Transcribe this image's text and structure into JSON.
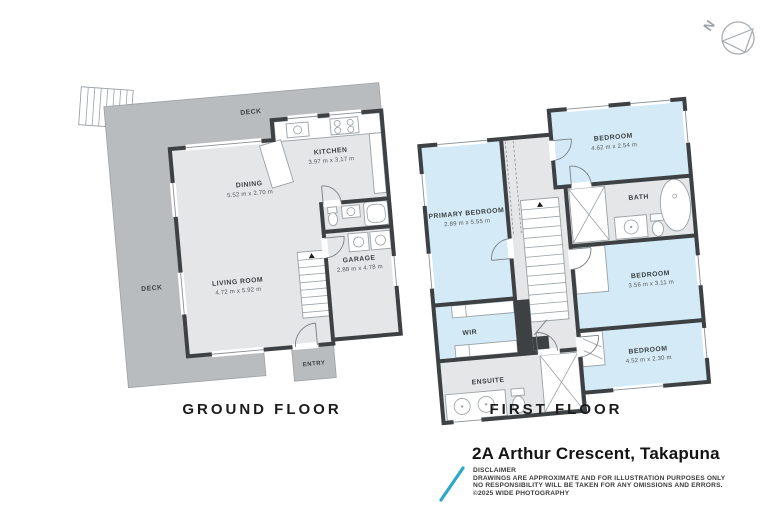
{
  "compass": {
    "north_label": "N"
  },
  "ground_floor": {
    "title": "GROUND FLOOR",
    "deck_label": "DECK",
    "rooms": {
      "kitchen": {
        "name": "KITCHEN",
        "dims": "3.97 m x 3.17 m"
      },
      "dining": {
        "name": "DINING",
        "dims": "5.52 m x 2.70 m"
      },
      "living": {
        "name": "LIVING ROOM",
        "dims": "4.72 m x 5.92 m"
      },
      "garage": {
        "name": "GARAGE",
        "dims": "2.88 m x 4.78 m"
      },
      "entry": {
        "name": "ENTRY"
      }
    }
  },
  "first_floor": {
    "title": "FIRST FLOOR",
    "rooms": {
      "primary": {
        "name": "PRIMARY BEDROOM",
        "dims": "2.89 m x 5.55 m"
      },
      "bedroom_top": {
        "name": "BEDROOM",
        "dims": "4.62 m x 2.54 m"
      },
      "bath": {
        "name": "BATH"
      },
      "bedroom_mid": {
        "name": "BEDROOM",
        "dims": "3.56 m x 3.11 m"
      },
      "bedroom_bottom": {
        "name": "BEDROOM",
        "dims": "4.52 m x 2.30 m"
      },
      "wir": {
        "name": "WIR"
      },
      "ensuite": {
        "name": "ENSUITE"
      }
    }
  },
  "footer": {
    "address": "2A Arthur Crescent, Takapuna",
    "disclaimer_title": "DISCLAIMER",
    "disclaimer_line1": "DRAWINGS ARE APPROXIMATE AND FOR ILLUSTRATION PURPOSES ONLY",
    "disclaimer_line2": "NO RESPONSIBILITY WILL BE TAKEN FOR ANY OMISSIONS AND ERRORS.",
    "disclaimer_line3": "©2025 WIDE PHOTOGRAPHY"
  },
  "colors": {
    "deck_fill": "#b9bcbe",
    "room_fill": "#e4e6e8",
    "bedroom_fill": "#d4eaf6",
    "wall": "#3d4144",
    "accent_teal": "#2ba9cb"
  }
}
